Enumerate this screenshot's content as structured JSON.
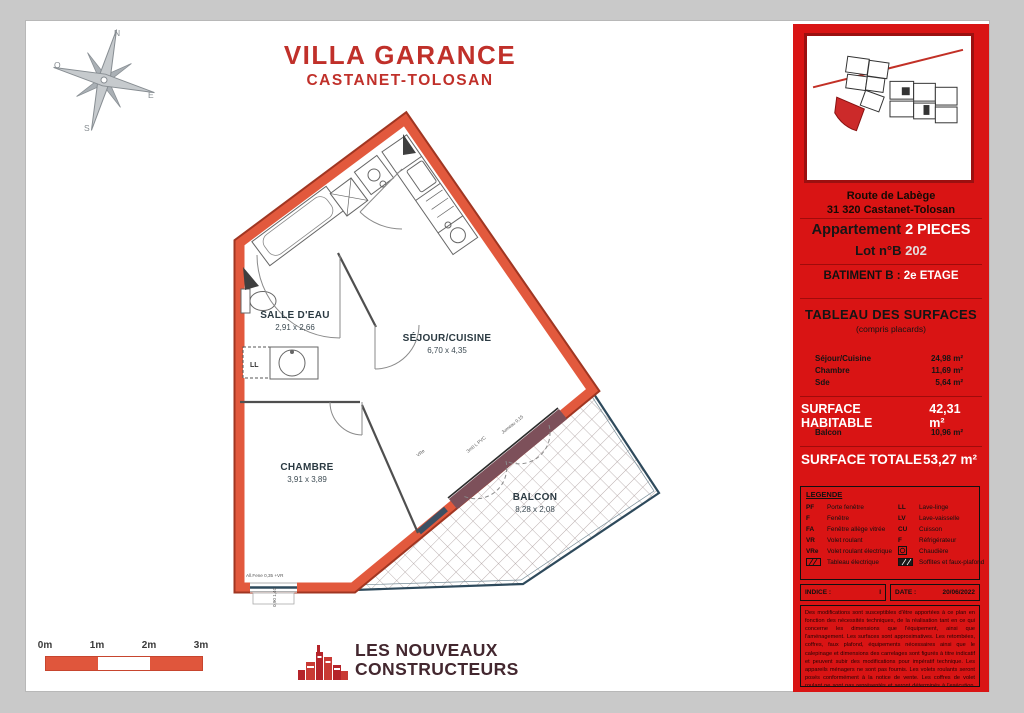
{
  "header": {
    "line1": "VILLA GARANCE",
    "line2": "CASTANET-TOLOSAN"
  },
  "compass": {
    "n": "N",
    "e": "E",
    "s": "S",
    "o": "O"
  },
  "plan": {
    "rooms": [
      {
        "name": "SALLE D'EAU",
        "dims": "2,91 x 2,66"
      },
      {
        "name": "SÉJOUR/CUISINE",
        "dims": "6,70 x 4,35"
      },
      {
        "name": "CHAMBRE",
        "dims": "3,91 x 3,89"
      },
      {
        "name": "BALCON",
        "dims": "8,28 x 2,08"
      }
    ],
    "annotations": {
      "ll": "LL",
      "vre": "VRe",
      "pvc": "3m0 L PVC",
      "jumeau": "Jumeau 0,15",
      "allege": "All.Fene 0,35  +VR",
      "win_dim": "0,90 1,40"
    }
  },
  "scalebar": {
    "labels": [
      "0m",
      "1m",
      "2m",
      "3m"
    ]
  },
  "logo": {
    "line1": "LES NOUVEAUX",
    "line2": "CONSTRUCTEURS"
  },
  "panel": {
    "address_line1": "Route de Labège",
    "address_line2": "31 320 Castanet-Tolosan",
    "apt_label": "Appartement",
    "apt_type": "2 PIECES",
    "lot_label": "Lot n°B",
    "lot_value": "202",
    "batiment": "BATIMENT B :",
    "etage": "2e ETAGE",
    "table_title": "TABLEAU DES SURFACES",
    "table_subtitle": "(compris placards)",
    "surfaces": [
      {
        "label": "Séjour/Cuisine",
        "value": "24,98 m²"
      },
      {
        "label": "Chambre",
        "value": "11,69 m²"
      },
      {
        "label": "Sde",
        "value": "5,64 m²"
      }
    ],
    "hab_label": "SURFACE HABITABLE",
    "hab_value": "42,31 m²",
    "balcon_label": "Balcon",
    "balcon_value": "10,96 m²",
    "tot_label": "SURFACE TOTALE",
    "tot_value": "53,27 m²",
    "legend": {
      "title": "LEGENDE",
      "left": [
        {
          "abbr": "PF",
          "label": "Porte fenêtre"
        },
        {
          "abbr": "F",
          "label": "Fenêtre"
        },
        {
          "abbr": "FA",
          "label": "Fenêtre allège vitrée"
        },
        {
          "abbr": "VR",
          "label": "Volet roulant"
        },
        {
          "abbr": "VRe",
          "label": "Volet roulant électrique"
        },
        {
          "abbr": "",
          "label": "Tableau électrique"
        }
      ],
      "right": [
        {
          "abbr": "LL",
          "label": "Lave-linge"
        },
        {
          "abbr": "LV",
          "label": "Lave-vaisselle"
        },
        {
          "abbr": "CU",
          "label": "Cuisson"
        },
        {
          "abbr": "F",
          "label": "Réfrigérateur"
        },
        {
          "abbr": "",
          "label": "Chaudière"
        },
        {
          "abbr": "",
          "label": "Soffites et faux-plafond"
        }
      ]
    },
    "indice_label": "INDICE :",
    "indice_value": "I",
    "date_label": "DATE :",
    "date_value": "20/06/2022",
    "disclaimer": "Des modifications sont susceptibles d'être apportées à ce plan en fonction des nécessités techniques, de la réalisation tant en ce qui concerne les dimensions que l'équipement, ainsi que l'aménagement. Les surfaces sont approximatives. Les retombées, coffres, faux plafond, équipements nécessaires ainsi que le calepinage et dimensions des carrelages sont figurés à titre indicatif et peuvent subir des modifications pour impératif technique. Les appareils ménagers ne sont pas fournis. Les volets roulants seront posés conformément à la notice de vente. Les coffres de volet roulant ne sont pas représentés et seront déterminés à l'exécution. La hauteur d'allège au droit des porte-fenêtres sur balcon ou terrasse pourra varier de 5 à 35 cm à partir du sol intérieur. La hauteur entre le jardin et la terrasse pourra varier entre 0 et 60 cm. Les jardins ne seront pas nécessairement plats et pourront comporter des talus et des pentes."
  },
  "colors": {
    "panel_red": "#d91414",
    "wall_orange": "#e2593d",
    "wall_outline": "#a03622",
    "balcony_band": "#7d505a",
    "title_red": "#c0302a",
    "logo_red": "#b5242a",
    "logo_text": "#43272f",
    "scale_red": "#e0563c"
  }
}
